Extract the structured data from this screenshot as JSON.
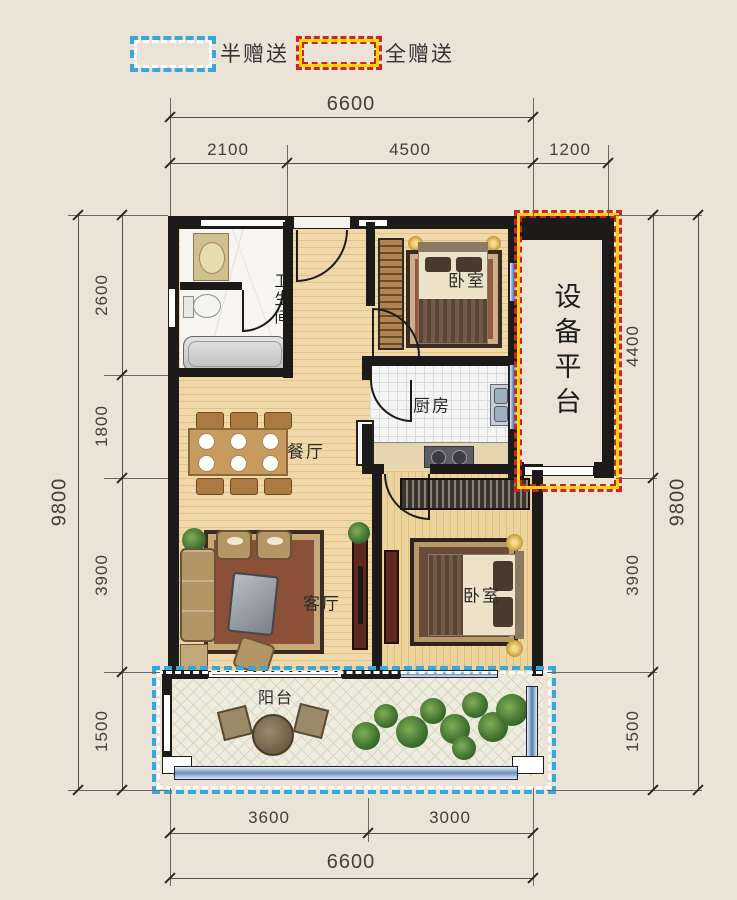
{
  "title": "apartment-floor-plan",
  "legend": {
    "half_label": "半赠送",
    "full_label": "全赠送"
  },
  "rooms": {
    "bathroom": "卫生间",
    "bedroom_top": "卧室",
    "bedroom_bottom": "卧室",
    "kitchen": "厨房",
    "dining": "餐厅",
    "living": "客厅",
    "balcony": "阳台",
    "equipment_platform": "设备平台"
  },
  "dimensions": {
    "top": {
      "total": "6600",
      "segments": [
        "2100",
        "4500",
        "1200"
      ]
    },
    "bottom": {
      "total": "6600",
      "segments": [
        "3600",
        "3000"
      ]
    },
    "left": {
      "total": "9800",
      "segments": [
        "2600",
        "1800",
        "3900",
        "1500"
      ]
    },
    "right": {
      "total": "9800",
      "segments": [
        "4400",
        "3900",
        "1500"
      ]
    }
  },
  "colors": {
    "background": "#ece3d7",
    "wall": "#1c1b19",
    "half_gift_border": "#35a8dc",
    "full_gift_border": "#cf2328",
    "full_gift_inner": "#ffd400",
    "wood_floor": "#f0d8a9"
  }
}
